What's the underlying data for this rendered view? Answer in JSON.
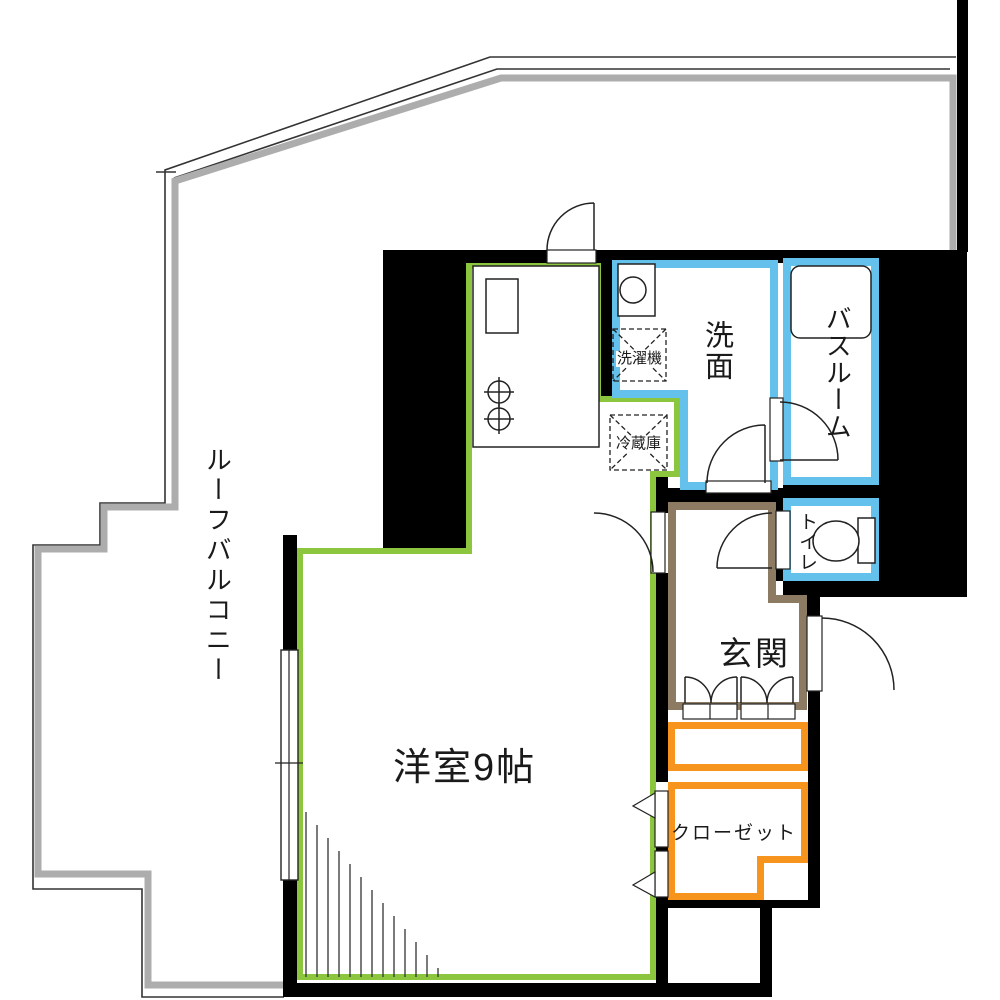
{
  "title": "apartment-floor-plan",
  "rooms": {
    "roof_balcony": {
      "label": "ルーフバルコニー"
    },
    "living": {
      "label": "洋室9帖"
    },
    "washroom": {
      "label": "洗面"
    },
    "bathroom": {
      "label": "バスルーム"
    },
    "toilet": {
      "label": "トイレ"
    },
    "entrance": {
      "label": "玄関"
    },
    "closet": {
      "label": "クローゼット"
    }
  },
  "fixtures": {
    "washing_machine": {
      "label": "洗濯機"
    },
    "refrigerator": {
      "label": "冷蔵庫"
    }
  },
  "palette": {
    "living_border": "#8CC63F",
    "water_border": "#63C1EC",
    "entrance_border": "#8C7A62",
    "storage_border": "#F7941D",
    "wall": "#000000",
    "balcony_wall": "#ADADAD",
    "line": "#222222"
  }
}
